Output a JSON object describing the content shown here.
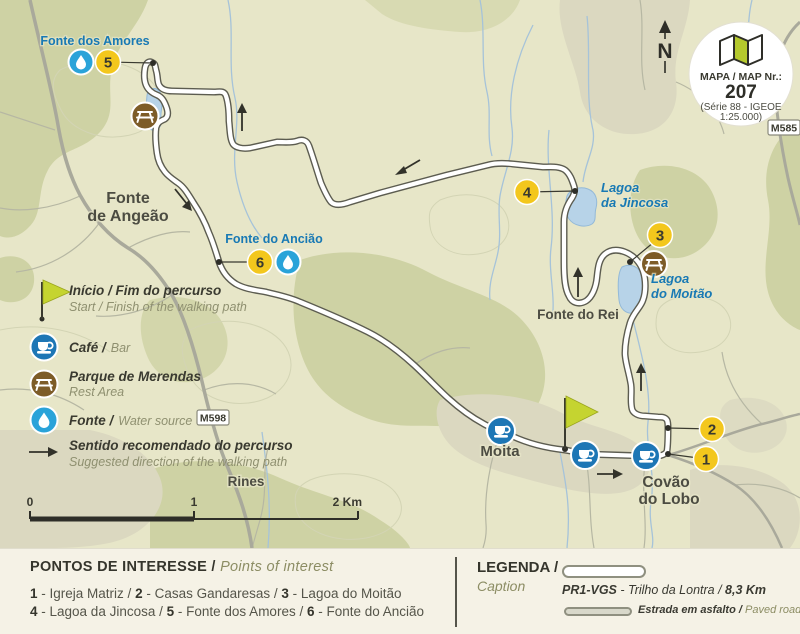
{
  "colors": {
    "map_bg": "#e7e6c8",
    "terrain_dark": "#ced2a4",
    "terrain_tan": "#dbd8c0",
    "trail_casing": "#5c5c50",
    "road_gray": "#a9a99b",
    "stream_blue": "#a6c3d9",
    "lake_fill": "#b7d3e8",
    "marker_yellow": "#f3c71d",
    "cafe_blue": "#1d76b5",
    "drop_blue": "#2aa3d9",
    "picnic_brown": "#7d5c28",
    "flag_green": "#c5d430",
    "label_blue": "#1879b4",
    "panel_bg": "#f5f2e6"
  },
  "map": {
    "north": "N",
    "badge": {
      "line1": "MAPA / MAP Nr.:",
      "number": "207",
      "line2": "(Série 88 - IGEOE",
      "line3": "1:25.000)"
    },
    "road_labels": {
      "m585": "M585",
      "m598": "M598"
    },
    "places": {
      "fonte_de_angeao_1": "Fonte",
      "fonte_de_angeao_2": "de Angeão",
      "moita": "Moita",
      "covao_1": "Covão",
      "covao_2": "do Lobo",
      "rines": "Rines",
      "fonte_do_rei": "Fonte do Rei"
    },
    "water_labels": {
      "fonte_dos_amores": "Fonte dos Amores",
      "fonte_do_anciao": "Fonte do Ancião",
      "jincosa_1": "Lagoa",
      "jincosa_2": "da Jincosa",
      "moitao_1": "Lagoa",
      "moitao_2": "do Moitão"
    },
    "markers": {
      "m1": "1",
      "m2": "2",
      "m3": "3",
      "m4": "4",
      "m5": "5",
      "m6": "6"
    },
    "key": {
      "inicio_pt": "Início / Fim do percurso",
      "inicio_en": "Start / Finish of the walking path",
      "cafe_pt": "Café /",
      "cafe_en": "Bar",
      "parque_pt": "Parque de Merendas",
      "parque_en": "Rest Area",
      "fonte_pt": "Fonte /",
      "fonte_en": "Water source",
      "sentido_pt": "Sentido recomendado do percurso",
      "sentido_en": "Suggested direction of the walking path"
    },
    "scale": {
      "t0": "0",
      "t1": "1",
      "t2": "2 Km"
    }
  },
  "panel": {
    "poi_title_pt": "PONTOS DE INTERESSE /",
    "poi_title_en": "Points of interest",
    "sep_dash": " - ",
    "sep_slash": " / ",
    "items": [
      {
        "num": "1",
        "name": "Igreja Matriz"
      },
      {
        "num": "2",
        "name": "Casas Gandaresas"
      },
      {
        "num": "3",
        "name": "Lagoa do Moitão"
      },
      {
        "num": "4",
        "name": "Lagoa da Jincosa"
      },
      {
        "num": "5",
        "name": "Fonte dos Amores"
      },
      {
        "num": "6",
        "name": "Fonte do Ancião"
      }
    ],
    "legenda_title_pt": "LEGENDA /",
    "legenda_title_en": "Caption",
    "trail_code": "PR1-VGS",
    "trail_name": " - Trilho da Lontra / ",
    "trail_km": "8,3 Km",
    "road_pt": "Estrada em asfalto /",
    "road_en": "Paved road"
  }
}
